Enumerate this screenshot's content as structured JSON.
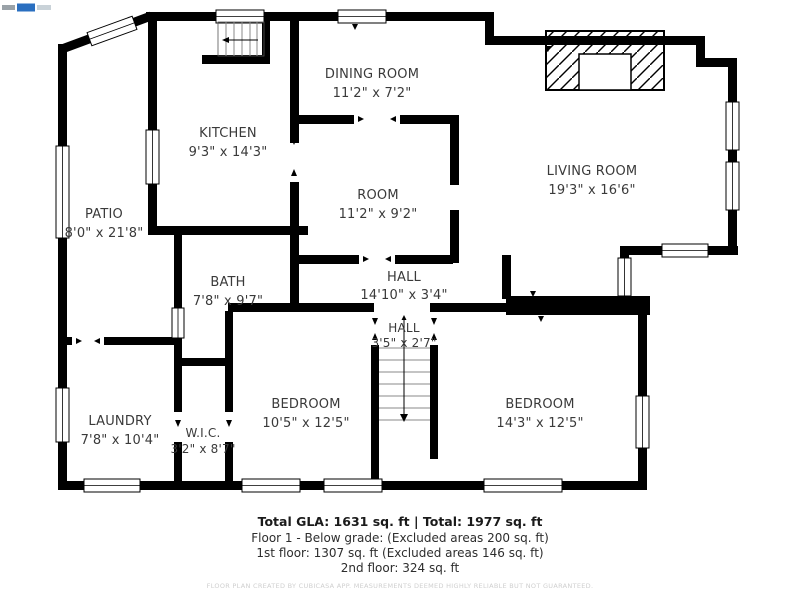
{
  "watermark": {
    "icon": "cubicasa-watermark-logo"
  },
  "plan": {
    "rooms": {
      "patio": {
        "name": "PATIO",
        "dims": "8'0\" x 21'8\""
      },
      "kitchen": {
        "name": "KITCHEN",
        "dims": "9'3\" x 14'3\""
      },
      "dining": {
        "name": "DINING ROOM",
        "dims": "11'2\" x 7'2\""
      },
      "living": {
        "name": "LIVING ROOM",
        "dims": "19'3\" x 16'6\""
      },
      "room": {
        "name": "ROOM",
        "dims": "11'2\" x 9'2\""
      },
      "bath": {
        "name": "BATH",
        "dims": "7'8\" x 9'7\""
      },
      "hall": {
        "name": "HALL",
        "dims": "14'10\" x 3'4\""
      },
      "hall2": {
        "name": "HALL",
        "dims": "3'5\" x 2'7\""
      },
      "laundry": {
        "name": "LAUNDRY",
        "dims": "7'8\" x 10'4\""
      },
      "wic": {
        "name": "W.I.C.",
        "dims": "3'2\" x 8'7\""
      },
      "bedroom1": {
        "name": "BEDROOM",
        "dims": "10'5\" x 12'5\""
      },
      "bedroom2": {
        "name": "BEDROOM",
        "dims": "14'3\" x 12'5\""
      }
    }
  },
  "summary": {
    "total_line": "Total GLA: 1631 sq. ft | Total: 1977 sq. ft",
    "lines": [
      "Floor 1 - Below grade: (Excluded areas 200 sq. ft)",
      "1st floor: 1307 sq. ft (Excluded areas 146 sq. ft)",
      "2nd floor: 324 sq. ft"
    ],
    "disclaimer": "FLOOR PLAN CREATED BY CUBICASA APP. MEASUREMENTS DEEMED HIGHLY RELIABLE BUT NOT GUARANTEED."
  },
  "colors": {
    "wall": "#000000",
    "label_text": "#3a3a3a",
    "disclaimer_text": "#cfcfcf",
    "watermark_blue": "#2a6fc0"
  }
}
